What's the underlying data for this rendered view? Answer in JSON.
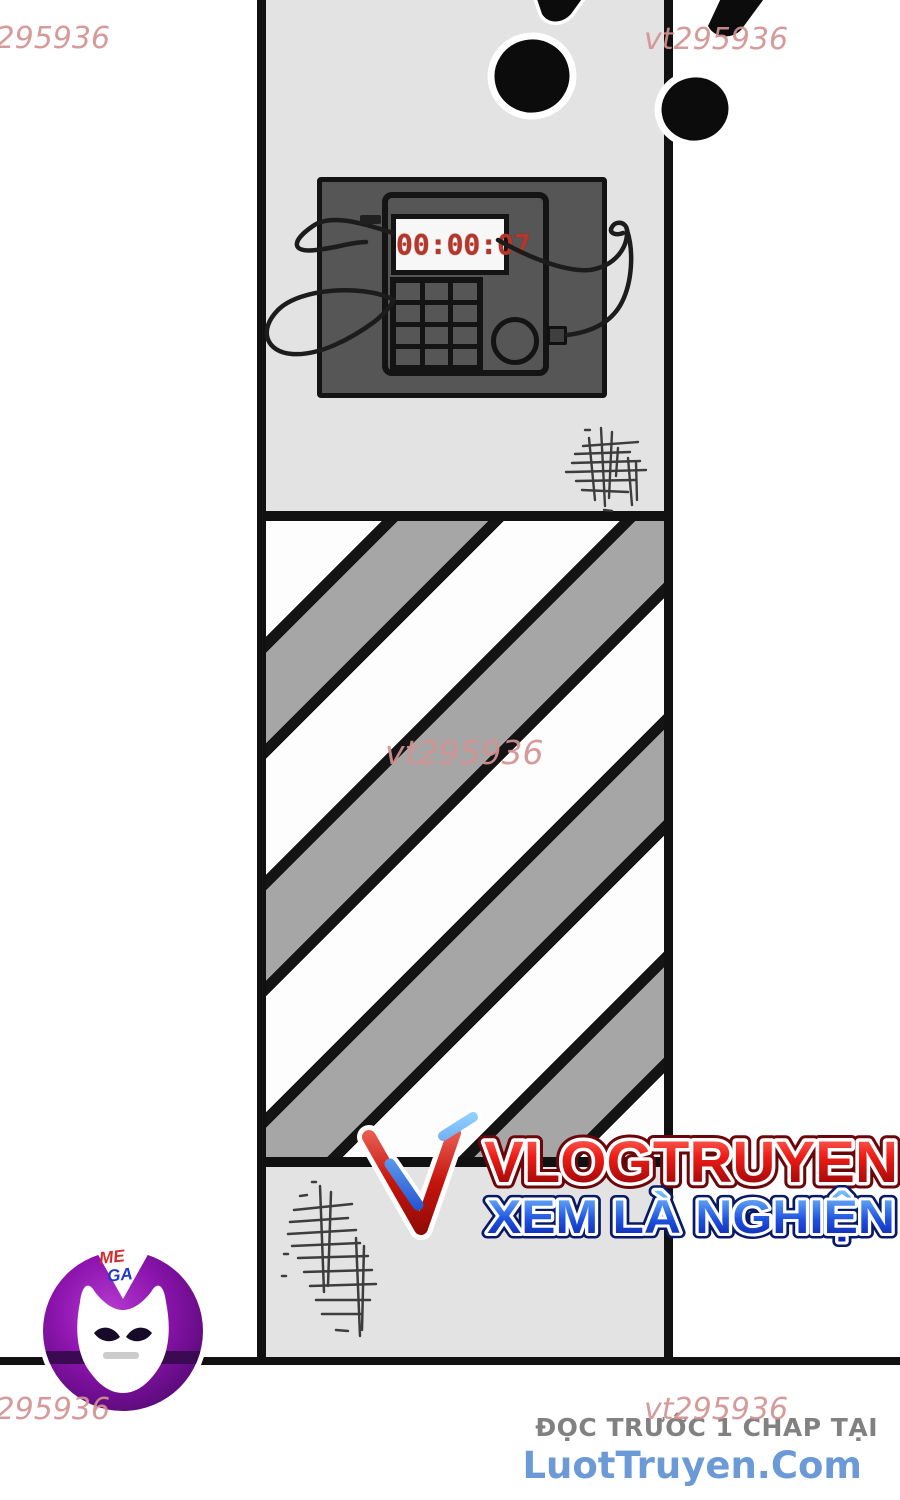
{
  "watermarks": {
    "full": "vt295936"
  },
  "panel": {
    "timer_display": "00:00:07"
  },
  "logo": {
    "title": "VLOGTRUYEN",
    "tagline": "XEM LÀ NGHIỆN"
  },
  "mascot": {
    "badge_line1": "ME",
    "badge_line2": "GA"
  },
  "footer": {
    "promo": "ĐỌC TRƯỚC 1 CHAP TẠI",
    "site": "LuotTruyen.Com"
  },
  "colors": {
    "watermark_pink": "#d49292",
    "panel_gray": "#e3e3e3",
    "stripe_gray": "#a6a6a6",
    "bomb_body_gray": "#565656",
    "timer_red": "#b5362a",
    "logo_red": "#c6150d",
    "logo_blue": "#1d4fd0",
    "footer_site_blue": "#6b9ad6",
    "footer_promo_gray": "#818181",
    "mascot_purple": "#8d14ae"
  }
}
